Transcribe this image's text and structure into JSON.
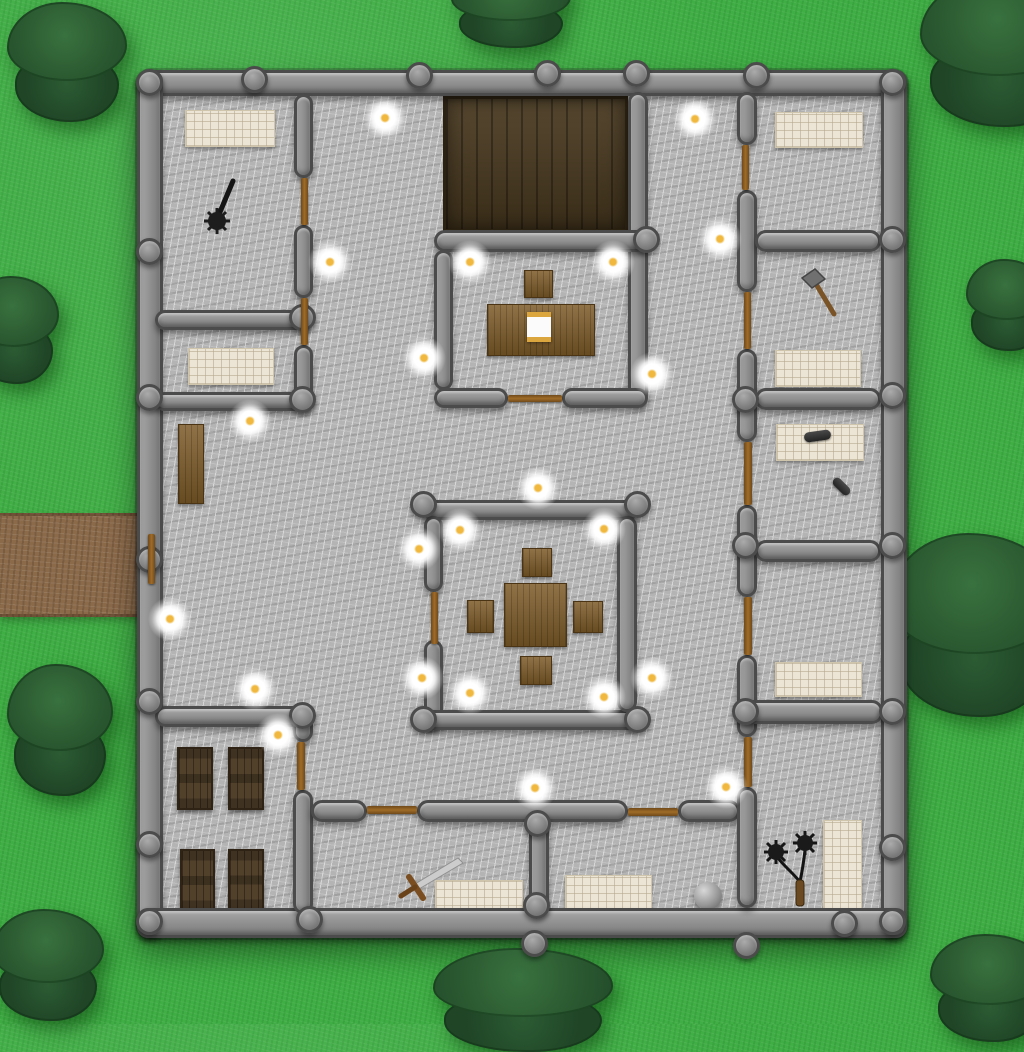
{
  "scene": {
    "kind": "top-down castle dungeon map",
    "palette": {
      "grass": "#3fae44",
      "tree": "#2a5830",
      "tree_dark": "#1f4426",
      "stone_floor": "#b4b4b4",
      "wall": "#8d8d8d",
      "wall_outline": "#4b4b4b",
      "wood_floor": "#4a3a20",
      "furniture_wood": "#7d5b28",
      "crate_wood": "#51402a",
      "bed": "#ece4d4",
      "door": "#a06c28",
      "path": "#8b6a4a",
      "torch_core": "#f0b83e",
      "torch_glow": "#ffffff",
      "iron_dark": "#1d1d1d",
      "blade": "#cccccc"
    }
  },
  "terrain": {
    "path": {
      "x": 0,
      "y": 513,
      "w": 152,
      "h": 104
    },
    "trees": [
      {
        "x": 3,
        "y": 2,
        "w": 128,
        "h": 120
      },
      {
        "x": 447,
        "y": -32,
        "w": 128,
        "h": 80
      },
      {
        "x": 915,
        "y": -23,
        "w": 170,
        "h": 150
      },
      {
        "x": -34,
        "y": 276,
        "w": 96,
        "h": 108
      },
      {
        "x": 963,
        "y": 259,
        "w": 88,
        "h": 92
      },
      {
        "x": 883,
        "y": 533,
        "w": 184,
        "h": 184
      },
      {
        "x": 4,
        "y": 664,
        "w": 112,
        "h": 132
      },
      {
        "x": -12,
        "y": 909,
        "w": 120,
        "h": 112
      },
      {
        "x": 427,
        "y": 948,
        "w": 192,
        "h": 104
      },
      {
        "x": 926,
        "y": 934,
        "w": 128,
        "h": 108
      }
    ]
  },
  "building": {
    "floor": {
      "x": 137,
      "y": 70,
      "w": 770,
      "h": 868
    },
    "wood_floor": {
      "x": 443,
      "y": 96,
      "w": 185,
      "h": 136
    },
    "walls": [
      {
        "x": 137,
        "y": 70,
        "w": 770,
        "h": 26
      },
      {
        "x": 137,
        "y": 70,
        "w": 26,
        "h": 868
      },
      {
        "x": 881,
        "y": 70,
        "w": 26,
        "h": 868
      },
      {
        "x": 137,
        "y": 908,
        "w": 770,
        "h": 30
      },
      {
        "x": 294,
        "y": 94,
        "w": 19,
        "h": 84
      },
      {
        "x": 294,
        "y": 225,
        "w": 19,
        "h": 73
      },
      {
        "x": 294,
        "y": 345,
        "w": 19,
        "h": 62
      },
      {
        "x": 155,
        "y": 310,
        "w": 158,
        "h": 20
      },
      {
        "x": 155,
        "y": 392,
        "w": 158,
        "h": 19
      },
      {
        "x": 155,
        "y": 706,
        "w": 152,
        "h": 21
      },
      {
        "x": 293,
        "y": 706,
        "w": 20,
        "h": 36
      },
      {
        "x": 293,
        "y": 790,
        "w": 20,
        "h": 124
      },
      {
        "x": 311,
        "y": 800,
        "w": 56,
        "h": 22
      },
      {
        "x": 417,
        "y": 800,
        "w": 211,
        "h": 22
      },
      {
        "x": 678,
        "y": 800,
        "w": 62,
        "h": 22
      },
      {
        "x": 529,
        "y": 818,
        "w": 20,
        "h": 96
      },
      {
        "x": 628,
        "y": 92,
        "w": 20,
        "h": 312
      },
      {
        "x": 434,
        "y": 230,
        "w": 214,
        "h": 22
      },
      {
        "x": 434,
        "y": 250,
        "w": 19,
        "h": 140
      },
      {
        "x": 434,
        "y": 388,
        "w": 74,
        "h": 20
      },
      {
        "x": 562,
        "y": 388,
        "w": 86,
        "h": 20
      },
      {
        "x": 422,
        "y": 500,
        "w": 217,
        "h": 20
      },
      {
        "x": 424,
        "y": 516,
        "w": 19,
        "h": 76
      },
      {
        "x": 424,
        "y": 640,
        "w": 19,
        "h": 90
      },
      {
        "x": 422,
        "y": 710,
        "w": 217,
        "h": 20
      },
      {
        "x": 617,
        "y": 516,
        "w": 20,
        "h": 196
      },
      {
        "x": 737,
        "y": 92,
        "w": 20,
        "h": 53
      },
      {
        "x": 737,
        "y": 190,
        "w": 20,
        "h": 102
      },
      {
        "x": 737,
        "y": 349,
        "w": 20,
        "h": 93
      },
      {
        "x": 737,
        "y": 505,
        "w": 20,
        "h": 92
      },
      {
        "x": 737,
        "y": 655,
        "w": 20,
        "h": 82
      },
      {
        "x": 737,
        "y": 787,
        "w": 20,
        "h": 121
      },
      {
        "x": 755,
        "y": 230,
        "w": 126,
        "h": 22
      },
      {
        "x": 755,
        "y": 388,
        "w": 126,
        "h": 22
      },
      {
        "x": 755,
        "y": 540,
        "w": 126,
        "h": 22
      },
      {
        "x": 737,
        "y": 700,
        "w": 146,
        "h": 24
      }
    ],
    "knobs": [
      {
        "x": 150,
        "y": 83
      },
      {
        "x": 893,
        "y": 83
      },
      {
        "x": 150,
        "y": 922
      },
      {
        "x": 893,
        "y": 922
      },
      {
        "x": 255,
        "y": 80
      },
      {
        "x": 420,
        "y": 76
      },
      {
        "x": 548,
        "y": 74
      },
      {
        "x": 637,
        "y": 74
      },
      {
        "x": 757,
        "y": 76
      },
      {
        "x": 150,
        "y": 252
      },
      {
        "x": 150,
        "y": 398
      },
      {
        "x": 150,
        "y": 560
      },
      {
        "x": 150,
        "y": 702
      },
      {
        "x": 150,
        "y": 845
      },
      {
        "x": 893,
        "y": 240
      },
      {
        "x": 893,
        "y": 396
      },
      {
        "x": 893,
        "y": 546
      },
      {
        "x": 893,
        "y": 712
      },
      {
        "x": 893,
        "y": 848
      },
      {
        "x": 310,
        "y": 920
      },
      {
        "x": 535,
        "y": 944
      },
      {
        "x": 747,
        "y": 946
      },
      {
        "x": 845,
        "y": 924
      },
      {
        "x": 303,
        "y": 318
      },
      {
        "x": 303,
        "y": 400
      },
      {
        "x": 303,
        "y": 716
      },
      {
        "x": 647,
        "y": 240
      },
      {
        "x": 746,
        "y": 400
      },
      {
        "x": 746,
        "y": 546
      },
      {
        "x": 746,
        "y": 712
      },
      {
        "x": 538,
        "y": 824
      },
      {
        "x": 537,
        "y": 906
      },
      {
        "x": 424,
        "y": 505
      },
      {
        "x": 638,
        "y": 505
      },
      {
        "x": 424,
        "y": 720
      },
      {
        "x": 638,
        "y": 720
      }
    ],
    "doors": [
      {
        "x": 148,
        "y": 534,
        "w": 7,
        "h": 50,
        "o": "v"
      },
      {
        "x": 301,
        "y": 178,
        "w": 7,
        "h": 47,
        "o": "v"
      },
      {
        "x": 301,
        "y": 298,
        "w": 7,
        "h": 47,
        "o": "v"
      },
      {
        "x": 297,
        "y": 742,
        "w": 8,
        "h": 48,
        "o": "v"
      },
      {
        "x": 431,
        "y": 592,
        "w": 7,
        "h": 52,
        "o": "v"
      },
      {
        "x": 508,
        "y": 395,
        "w": 54,
        "h": 7,
        "o": "h"
      },
      {
        "x": 367,
        "y": 806,
        "w": 50,
        "h": 8,
        "o": "h"
      },
      {
        "x": 628,
        "y": 808,
        "w": 50,
        "h": 8,
        "o": "h"
      },
      {
        "x": 742,
        "y": 145,
        "w": 7,
        "h": 45,
        "o": "v"
      },
      {
        "x": 744,
        "y": 292,
        "w": 7,
        "h": 57,
        "o": "v"
      },
      {
        "x": 744,
        "y": 442,
        "w": 8,
        "h": 63,
        "o": "v"
      },
      {
        "x": 744,
        "y": 597,
        "w": 8,
        "h": 58,
        "o": "v"
      },
      {
        "x": 744,
        "y": 737,
        "w": 8,
        "h": 50,
        "o": "v"
      }
    ]
  },
  "furniture": {
    "beds": [
      {
        "x": 185,
        "y": 110,
        "w": 90,
        "h": 37
      },
      {
        "x": 188,
        "y": 348,
        "w": 86,
        "h": 37
      },
      {
        "x": 775,
        "y": 112,
        "w": 88,
        "h": 36
      },
      {
        "x": 775,
        "y": 350,
        "w": 86,
        "h": 37
      },
      {
        "x": 776,
        "y": 424,
        "w": 88,
        "h": 37
      },
      {
        "x": 775,
        "y": 662,
        "w": 87,
        "h": 35
      },
      {
        "x": 823,
        "y": 820,
        "w": 39,
        "h": 92
      },
      {
        "x": 435,
        "y": 880,
        "w": 88,
        "h": 35
      },
      {
        "x": 565,
        "y": 875,
        "w": 87,
        "h": 36
      }
    ],
    "wood_blocks": [
      {
        "kind": "desk",
        "x": 487,
        "y": 304,
        "w": 108,
        "h": 52
      },
      {
        "kind": "chair",
        "x": 524,
        "y": 270,
        "w": 29,
        "h": 28
      },
      {
        "kind": "dining-table",
        "x": 504,
        "y": 583,
        "w": 63,
        "h": 64
      },
      {
        "kind": "stool-north",
        "x": 522,
        "y": 548,
        "w": 30,
        "h": 29
      },
      {
        "kind": "stool-west",
        "x": 467,
        "y": 600,
        "w": 27,
        "h": 33
      },
      {
        "kind": "stool-east",
        "x": 573,
        "y": 601,
        "w": 30,
        "h": 32
      },
      {
        "kind": "stool-south",
        "x": 520,
        "y": 656,
        "w": 32,
        "h": 29
      },
      {
        "kind": "bench",
        "x": 178,
        "y": 424,
        "w": 26,
        "h": 80
      }
    ],
    "crates": [
      {
        "x": 177,
        "y": 747,
        "w": 36,
        "h": 63
      },
      {
        "x": 228,
        "y": 747,
        "w": 36,
        "h": 63
      },
      {
        "x": 180,
        "y": 849,
        "w": 35,
        "h": 63
      },
      {
        "x": 228,
        "y": 849,
        "w": 36,
        "h": 62
      }
    ],
    "scroll": {
      "x": 527,
      "y": 312,
      "w": 24,
      "h": 30
    }
  },
  "items": [
    {
      "kind": "mace",
      "x": 202,
      "y": 176,
      "w": 40,
      "h": 58
    },
    {
      "kind": "hammer",
      "x": 798,
      "y": 266,
      "w": 44,
      "h": 54
    },
    {
      "kind": "club",
      "x": 804,
      "y": 431,
      "w": 27,
      "h": 10,
      "rot": -8
    },
    {
      "kind": "club",
      "x": 831,
      "y": 482,
      "w": 21,
      "h": 9,
      "rot": 45
    },
    {
      "kind": "sword",
      "x": 392,
      "y": 855,
      "w": 72,
      "h": 46
    },
    {
      "kind": "flail",
      "x": 756,
      "y": 828,
      "w": 64,
      "h": 80
    },
    {
      "kind": "sphere",
      "x": 694,
      "y": 882,
      "w": 28,
      "h": 28
    }
  ],
  "torches": [
    {
      "x": 385,
      "y": 118
    },
    {
      "x": 695,
      "y": 119
    },
    {
      "x": 330,
      "y": 262
    },
    {
      "x": 470,
      "y": 262
    },
    {
      "x": 613,
      "y": 262
    },
    {
      "x": 720,
      "y": 239
    },
    {
      "x": 250,
      "y": 421
    },
    {
      "x": 424,
      "y": 358
    },
    {
      "x": 652,
      "y": 374
    },
    {
      "x": 170,
      "y": 619
    },
    {
      "x": 538,
      "y": 488
    },
    {
      "x": 460,
      "y": 530
    },
    {
      "x": 604,
      "y": 529
    },
    {
      "x": 419,
      "y": 549
    },
    {
      "x": 422,
      "y": 678
    },
    {
      "x": 470,
      "y": 693
    },
    {
      "x": 604,
      "y": 697
    },
    {
      "x": 652,
      "y": 678
    },
    {
      "x": 255,
      "y": 689
    },
    {
      "x": 278,
      "y": 735
    },
    {
      "x": 535,
      "y": 788
    },
    {
      "x": 726,
      "y": 787
    }
  ]
}
